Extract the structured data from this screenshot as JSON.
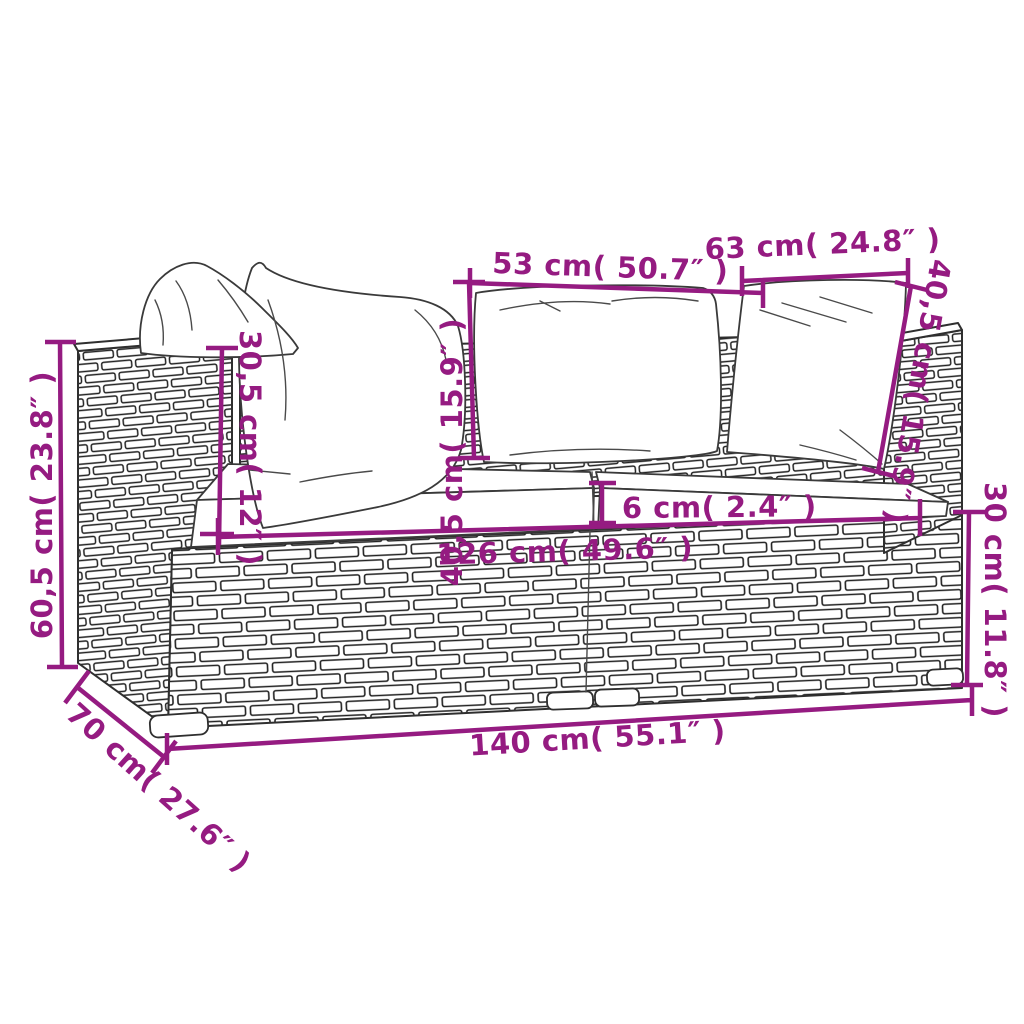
{
  "accent_color": "#951b81",
  "figure": "rattan-lounge-sofa-dimension-diagram",
  "dims": {
    "back_cushion_width_left": {
      "label": "53 cm( 50.7″ )"
    },
    "back_cushion_width_right": {
      "label": "63 cm( 24.8″ )"
    },
    "back_cushion_height_mid": {
      "label": "40,5 cm( 15.9″ )"
    },
    "back_cushion_height_right": {
      "label": "40,5 cm( 15.9″ )"
    },
    "armrest_above_seat": {
      "label": "30,5 cm( 12″ )"
    },
    "overall_height": {
      "label": "60,5 cm( 23.8″ )"
    },
    "seat_cushion_thickness": {
      "label": "6 cm( 2.4″ )"
    },
    "inner_seat_width": {
      "label": "126 cm( 49.6″ )"
    },
    "base_height": {
      "label": "30 cm( 11.8″ )"
    },
    "overall_width": {
      "label": "140 cm( 55.1″ )"
    },
    "overall_depth": {
      "label": "70 cm( 27.6″ )"
    }
  }
}
